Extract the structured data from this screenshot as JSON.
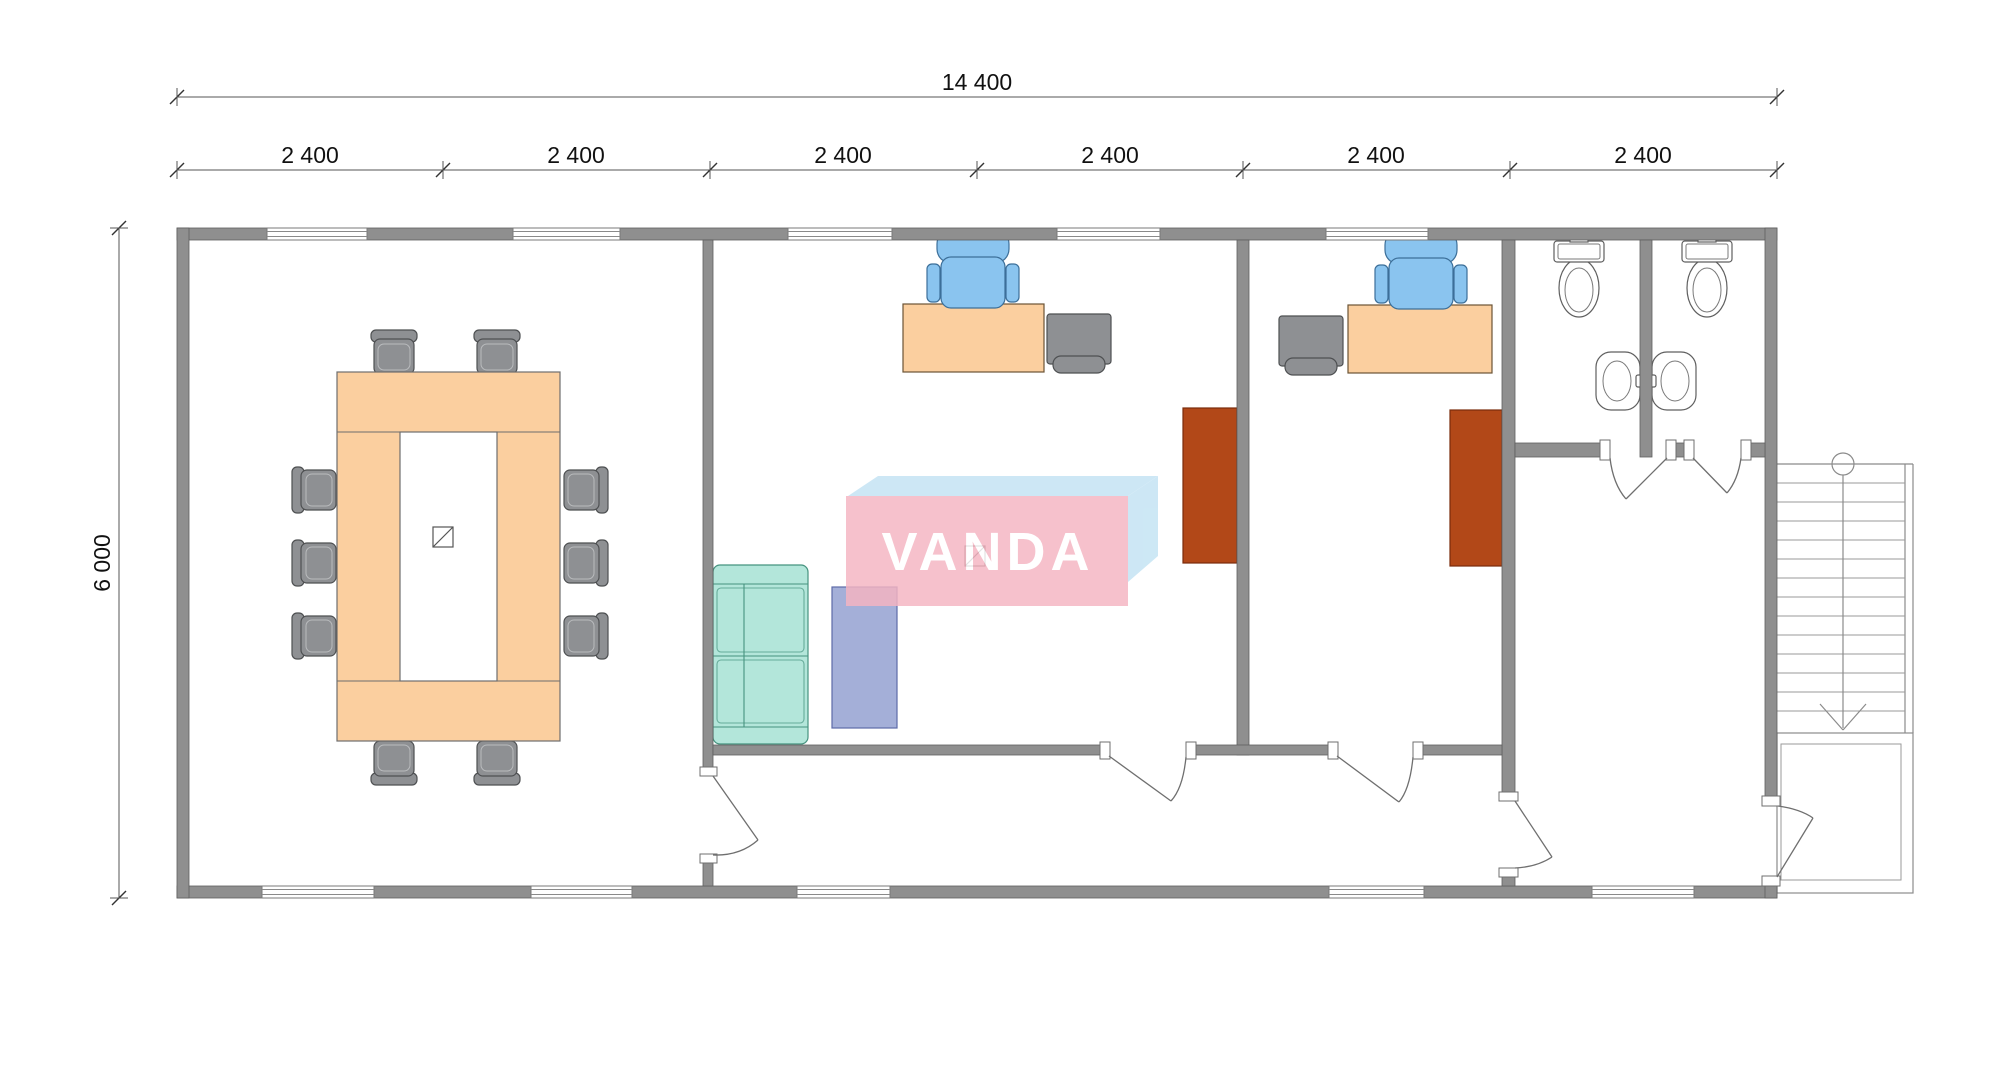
{
  "dimensions": {
    "total_width": "14 400",
    "building_height": "6 000",
    "segments": [
      "2 400",
      "2 400",
      "2 400",
      "2 400",
      "2 400",
      "2 400"
    ]
  },
  "logo": {
    "text": "VANDA"
  },
  "colors": {
    "wall": "#8f8f8f",
    "walledge": "#5e5e5e",
    "desk": "#fbcf9f",
    "chairgray": "#8e9093",
    "chairblue": "#8ac4ef",
    "sofa": "#b3e6da",
    "rug": "#8d9bce",
    "wardrobe": "#b24818",
    "logopink": "#f5b5c2",
    "logoblue": "#c3e3f3"
  }
}
